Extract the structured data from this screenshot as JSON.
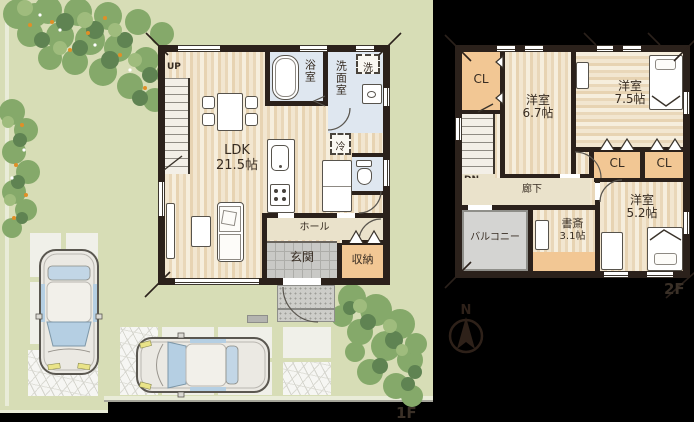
{
  "floor1": {
    "label": "1F",
    "stairs_label": "UP",
    "ldk": {
      "name": "LDK",
      "size": "21.5帖"
    },
    "bath": "浴室",
    "laundry": "洗",
    "washroom": "洗面室",
    "fridge": "冷",
    "hall": "ホール",
    "entrance": "玄関",
    "storage": "収納"
  },
  "floor2": {
    "label": "2F",
    "stairs_label": "DN",
    "closet1": "CL",
    "closet2": "CL",
    "closet3": "CL",
    "room_a": {
      "name": "洋室",
      "size": "6.7帖"
    },
    "room_b": {
      "name": "洋室",
      "size": "7.5帖"
    },
    "room_c": {
      "name": "洋室",
      "size": "5.2帖"
    },
    "study": {
      "name": "書斎",
      "size": "3.1帖"
    },
    "corridor": "廊下",
    "balcony": "バルコニー"
  },
  "compass": {
    "north": "N"
  },
  "colors": {
    "site_green": "#d7ddb6",
    "wall_dark": "#2b211b",
    "wood_floor": "#f0e3cb",
    "wet_area_blue": "#dfe7f0",
    "closet_tan": "#f2c794",
    "hall_beige": "#eae2cb",
    "tile_gray": "#c9c9c6",
    "balcony_gray": "#d4d4d2",
    "shrub_green": "#85a96a",
    "text": "#372c22"
  }
}
